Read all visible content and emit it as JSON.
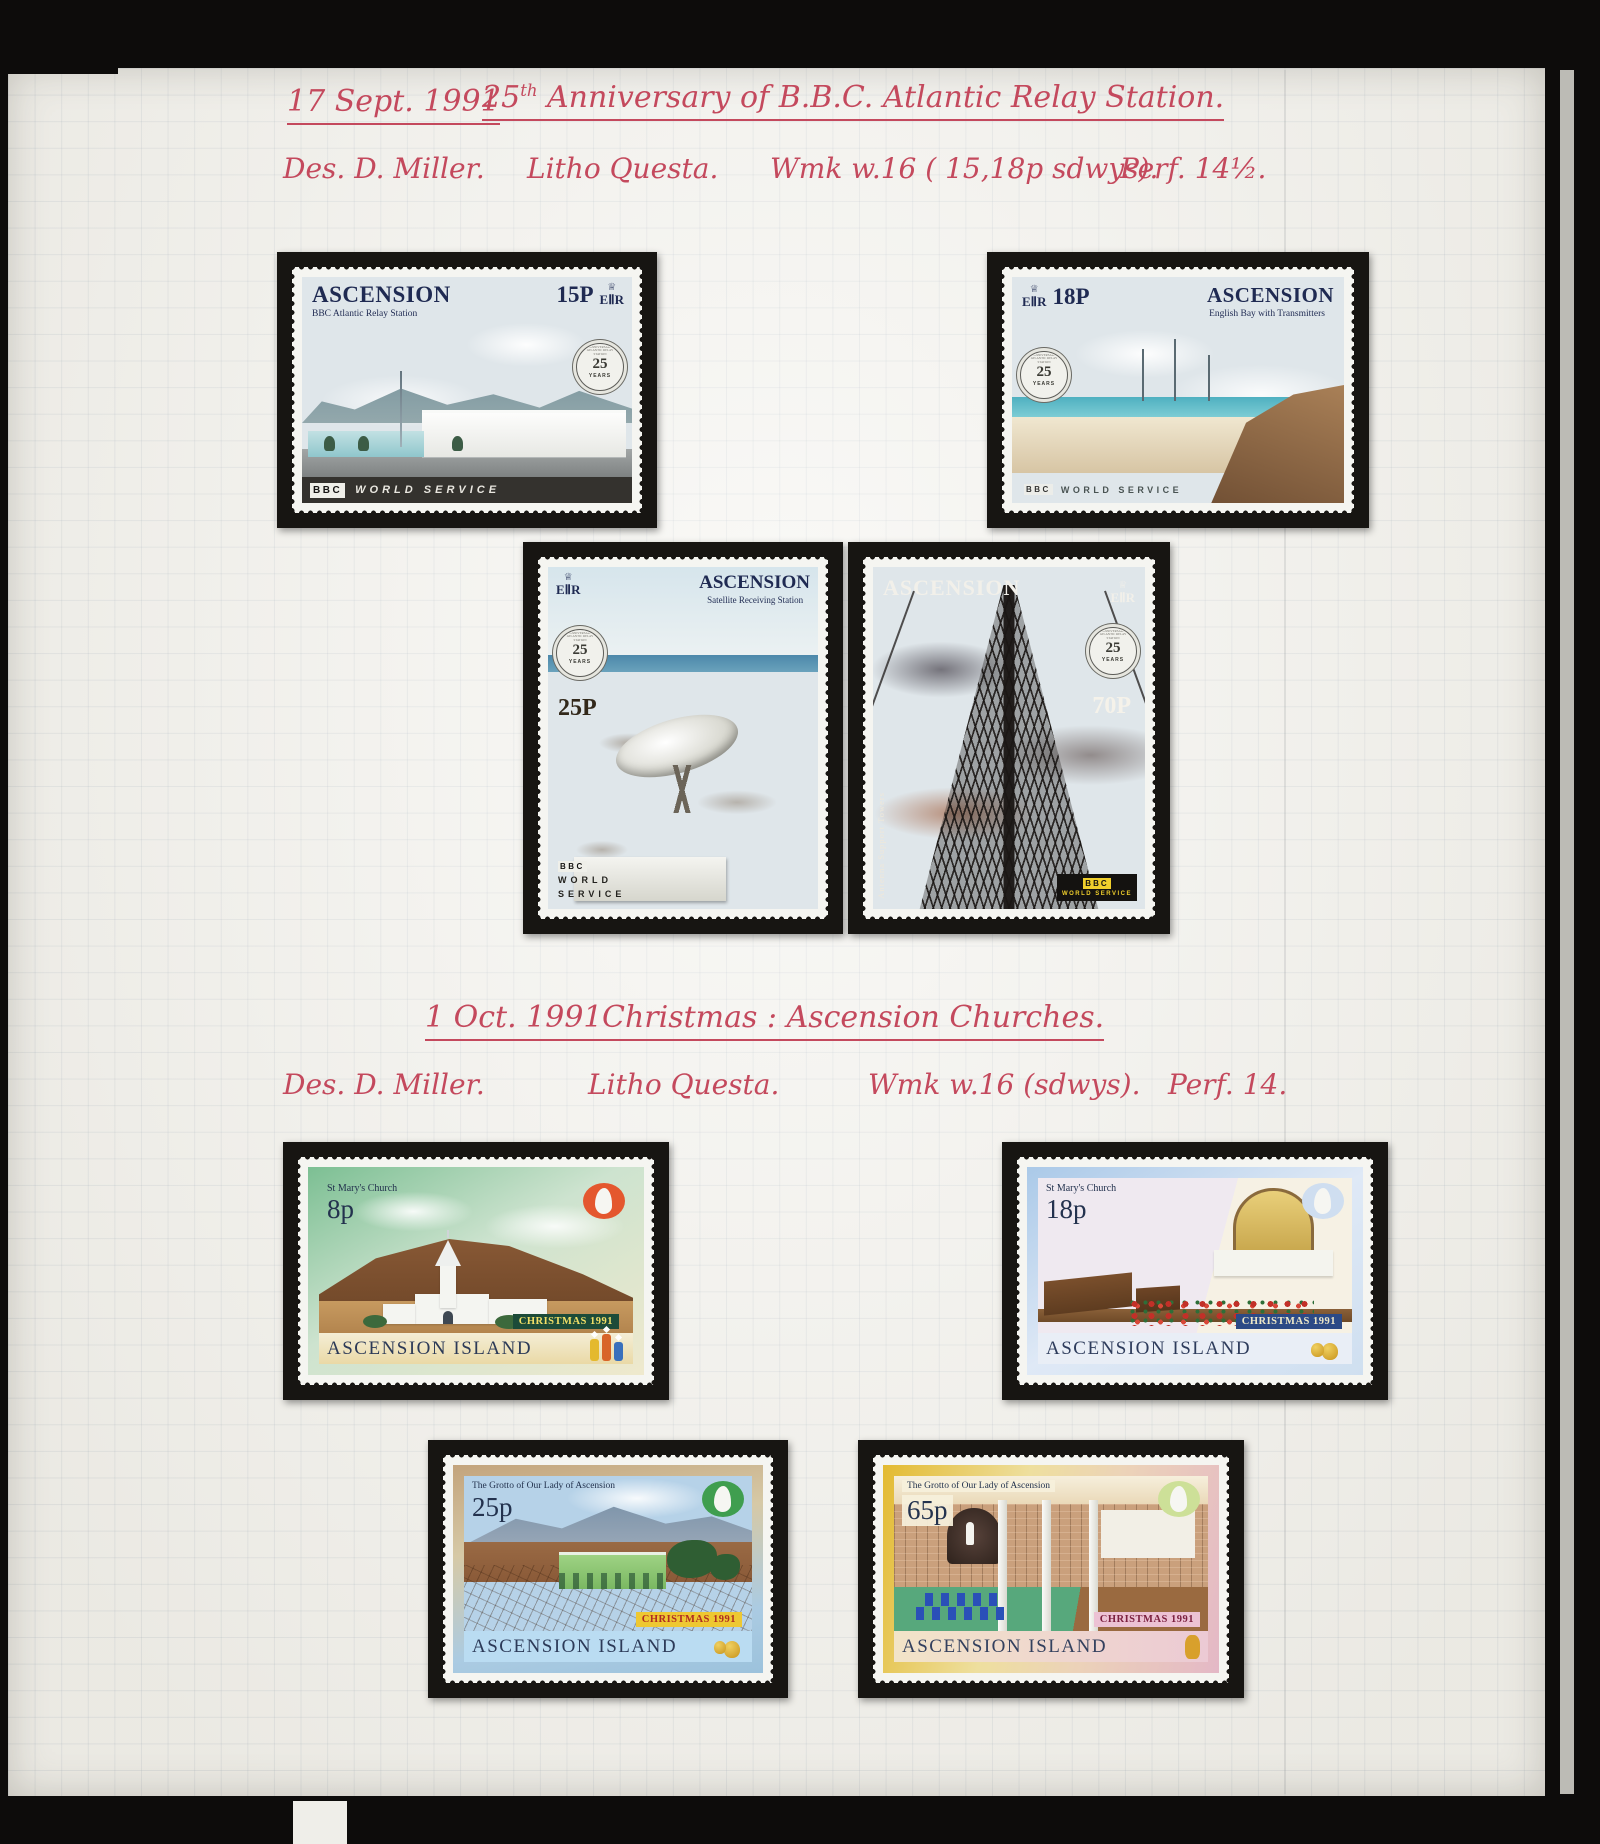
{
  "colors": {
    "handwriting_ink": "#c4495d",
    "paper": "#f3f2ed",
    "mount_black": "#171512",
    "stamp_navy": "#1f2a52",
    "bbc_band": "#34322e",
    "bbc_yellow": "#f0cf2c",
    "xmas_8p_border": "#7cbf93",
    "xmas_18p_border": "#aac9e8",
    "xmas_25p_border": "#c3a47c",
    "xmas_65p_border": "#e3ba31"
  },
  "icons": {
    "crown": "♕"
  },
  "headings": {
    "bbc": {
      "date": "17 Sept. 1991",
      "title_num": "25",
      "title_sup": "th",
      "title_rest": " Anniversary of B.B.C. Atlantic Relay Station.",
      "des": "Des. D. Miller.",
      "litho": "Litho Questa.",
      "wmk": "Wmk w.16 ( 15,18p sdwys).",
      "perf": "Perf. 14½."
    },
    "christmas": {
      "date": "1 Oct. 1991",
      "title": "Christmas : Ascension Churches.",
      "des": "Des. D. Miller.",
      "litho": "Litho Questa.",
      "wmk": "Wmk w.16 (sdwys).",
      "perf": "Perf. 14."
    }
  },
  "medallion": {
    "ring": "25th ANNIVERSARY OF ATLANTIC RELAY STATION",
    "years": "25",
    "label": "YEARS"
  },
  "stamps": [
    {
      "id": "bbc-15p",
      "country": "ASCENSION",
      "caption": "BBC Atlantic Relay Station",
      "value": "15P",
      "cipher": "EⅡR",
      "bbc": "BBC",
      "service": "WORLD SERVICE"
    },
    {
      "id": "bbc-18p",
      "country": "ASCENSION",
      "caption": "English Bay with Transmitters",
      "value": "18P",
      "cipher": "EⅡR",
      "bbc": "BBC",
      "service": "WORLD SERVICE"
    },
    {
      "id": "bbc-25p",
      "country": "ASCENSION",
      "caption": "Satellite Receiving Station",
      "value": "25P",
      "cipher": "EⅡR",
      "bbc": "BBC",
      "service_line1": "WORLD",
      "service_line2": "SERVICE"
    },
    {
      "id": "bbc-70p",
      "country": "ASCENSION",
      "caption": "Antenna Support Towers",
      "value": "70P",
      "cipher": "EⅡR",
      "bbc": "BBC",
      "service": "WORLD SERVICE"
    },
    {
      "id": "xmas-8p",
      "country": "ASCENSION ISLAND",
      "caption": "St Mary's Church",
      "value": "8p",
      "banner": "CHRISTMAS 1991"
    },
    {
      "id": "xmas-18p",
      "country": "ASCENSION ISLAND",
      "caption": "St Mary's Church",
      "value": "18p",
      "banner": "CHRISTMAS 1991"
    },
    {
      "id": "xmas-25p",
      "country": "ASCENSION ISLAND",
      "caption": "The Grotto of Our Lady of Ascension",
      "value": "25p",
      "banner": "CHRISTMAS 1991"
    },
    {
      "id": "xmas-65p",
      "country": "ASCENSION ISLAND",
      "caption": "The Grotto of Our Lady of Ascension",
      "value": "65p",
      "banner": "CHRISTMAS 1991"
    }
  ]
}
